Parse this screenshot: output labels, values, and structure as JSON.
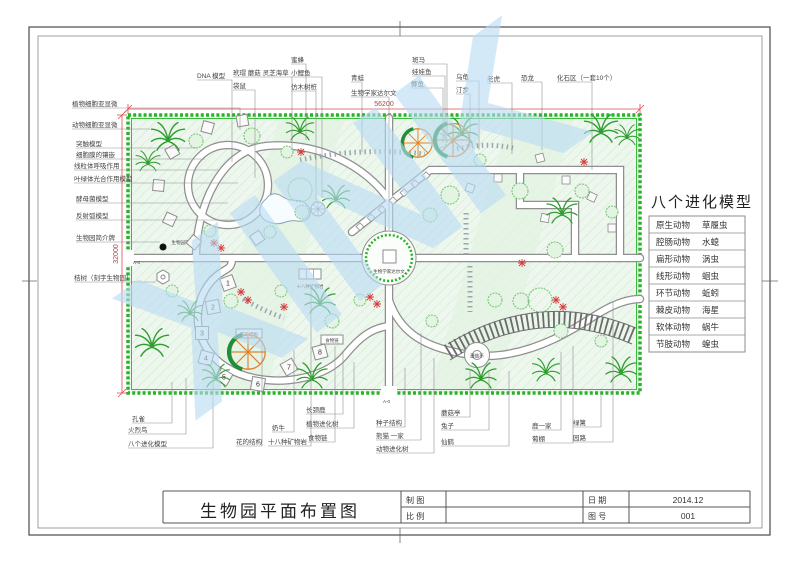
{
  "title_block": {
    "title": "生物园平面布置图",
    "maker_label": "制  图",
    "scale_label": "比  例",
    "date_label": "日  期",
    "no_label": "图  号",
    "date_value": "2014.12",
    "no_value": "001"
  },
  "evolution_panel": {
    "title": "八个进化模型",
    "rows": [
      [
        "原生动物",
        "草履虫"
      ],
      [
        "腔肠动物",
        "水螅"
      ],
      [
        "扁形动物",
        "涡虫"
      ],
      [
        "线形动物",
        "蛔虫"
      ],
      [
        "环节动物",
        "蚯蚓"
      ],
      [
        "棘皮动物",
        "海星"
      ],
      [
        "软体动物",
        "蜗牛"
      ],
      [
        "节肢动物",
        "蝗虫"
      ]
    ]
  },
  "dimensions": {
    "top": "56200",
    "left": "32000"
  },
  "plan": {
    "watermark": "XINK",
    "numbered_models": [
      "1",
      "2",
      "3",
      "4",
      "5",
      "6",
      "7",
      "8"
    ],
    "top_labels": [
      "DNA 模型",
      "玳瑁 蘑菇 灵芝海草",
      "袋鼠",
      "蜜蜂",
      "小鲤鱼",
      "仿木树桩",
      "青蛙",
      "生物学家达尔文",
      "斑马",
      "娃娃鱼",
      "鲫鱼",
      "乌龟",
      "汀步",
      "老虎",
      "恐龙",
      "化石区（一套10个）"
    ],
    "left_labels": [
      "植物细胞亚显微",
      "动物细胞亚显微",
      "突触模型",
      "细胞膜的镶嵌",
      "线粒体呼吸作用",
      "叶绿体光合作用模型",
      "酵母菌模型",
      "反射弧模型",
      "生物园简介牌",
      "桔树（刻字生物园）"
    ],
    "bottom_labels": [
      "孔雀",
      "火烈鸟",
      "八个进化模型",
      "花的结构",
      "奶牛",
      "十八种矿物岩",
      "长颈鹿",
      "植物进化树",
      "食物链",
      "种子结构",
      "熊猫 一家",
      "动物进化树",
      "蘑菇亭",
      "兔子",
      "仙鹤",
      "鹿一家",
      "葡棚",
      "绿篱",
      "园路"
    ],
    "inner_labels": {
      "darwin": "生物学家达尔文",
      "mushroom": "蘑菇亭",
      "minerals": "十八种矿物岩",
      "flower_structure": "花的结构",
      "food_chain": "食物链",
      "intro_board": "生物园简介牌",
      "entrance_left": "A-0",
      "entrance_bottom": "A-0"
    }
  },
  "colors": {
    "hedge_green": "#28b428",
    "lawn": "#edf7ed",
    "path_gray": "#8f8f8f",
    "dimension_red": "#d94f4f",
    "watermark_blue": "#b9dcf4",
    "flower_red": "#d63a3a",
    "orange_tree": "#e0832f"
  }
}
